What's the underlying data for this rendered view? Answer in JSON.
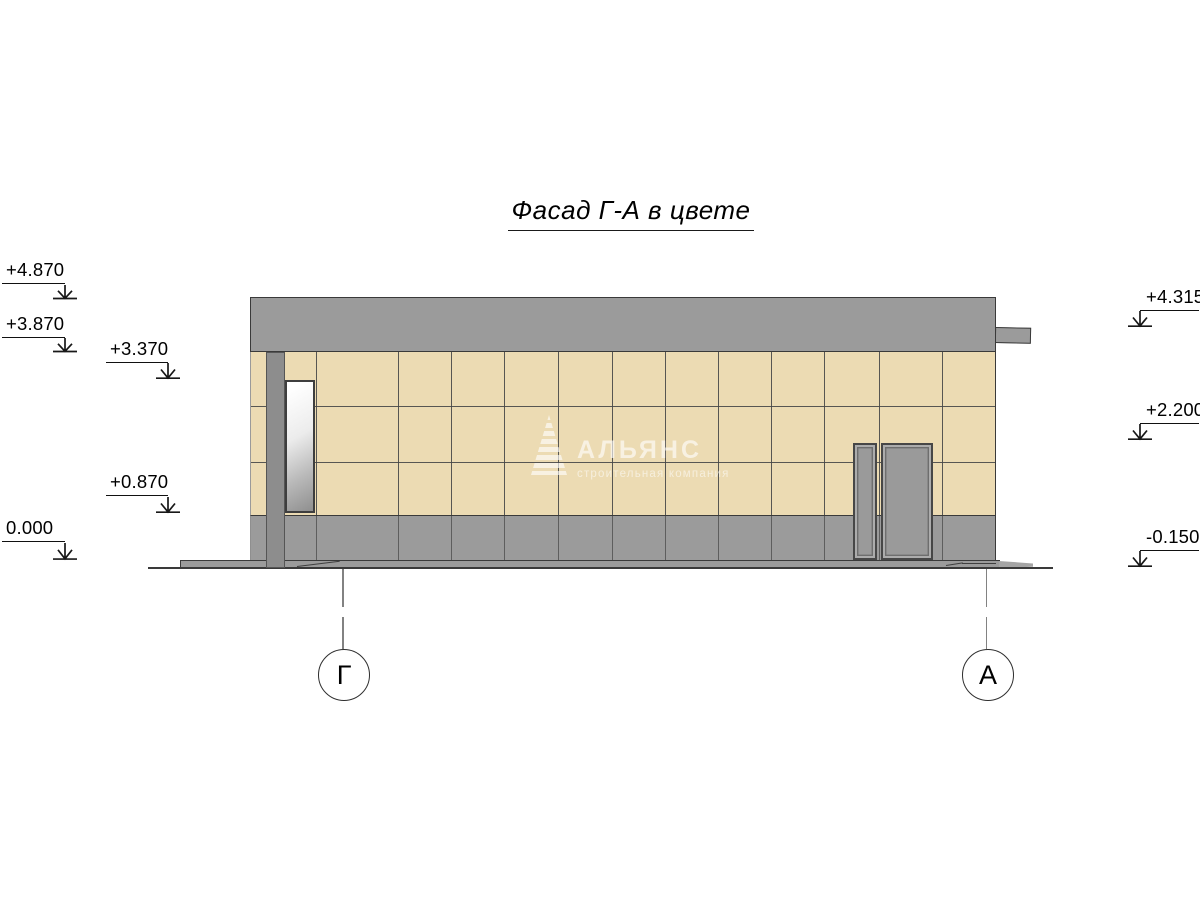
{
  "title": "Фасад Г-А в цвете",
  "elevation_marks": {
    "left": [
      {
        "label": "+4.870"
      },
      {
        "label": "+3.870"
      },
      {
        "label": "+3.370"
      },
      {
        "label": "+0.870"
      },
      {
        "label": "0.000"
      }
    ],
    "right": [
      {
        "label": "+4.315"
      },
      {
        "label": "+2.200"
      },
      {
        "label": "-0.150"
      }
    ]
  },
  "axis_bubbles": {
    "left": "Г",
    "right": "А"
  },
  "watermark": {
    "company": "АЛЬЯНС",
    "tagline": "строительная компания",
    "logo": "pyramid-logo"
  },
  "colors": {
    "facade_tile": "#ecdbb3",
    "band_gray": "#9b9b9b",
    "pilaster_gray": "#8d8d8d",
    "door_gray": "#9a9a9a",
    "outline": "#3a3a3a"
  },
  "facade_grid": {
    "vertical_joints": [
      65,
      147,
      200,
      253,
      307,
      361,
      414,
      467,
      520,
      573,
      628,
      691
    ],
    "horizontal_joints": [
      54,
      109.5
    ]
  }
}
